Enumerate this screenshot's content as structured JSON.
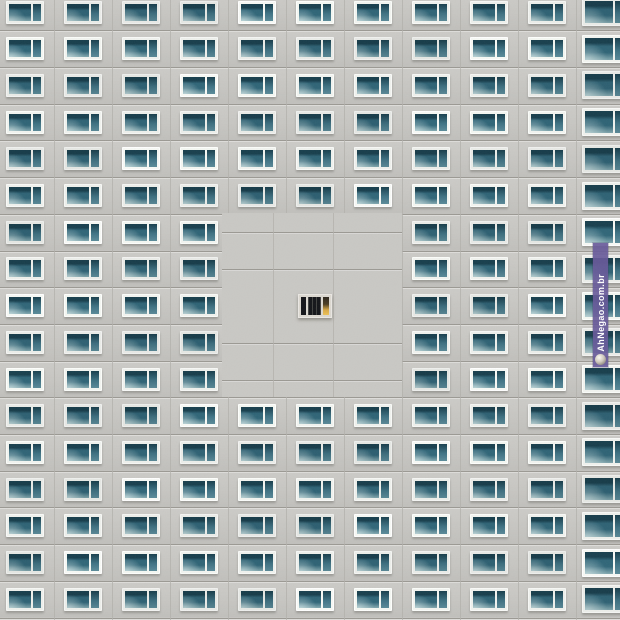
{
  "scene": {
    "description": "Prefab apartment building facade: uniform grid of teal windows, a cleared blank wall area in the middle, and one small lit window at its center",
    "colors": {
      "wall": "#c9c8c4",
      "floor_joint_line": "#9b9993",
      "panel_joint_line": "#b2b0ab"
    }
  },
  "facade": {
    "grid": {
      "columns": 11,
      "rows": 17,
      "col_start": 25,
      "col_step": 58,
      "row_start": 12,
      "row_step": 36.7
    },
    "window": {
      "width": 38,
      "height": 23,
      "frame_color": "#eef0ec",
      "glass_dark": "#173d4b",
      "glass_mid": "#2e6274",
      "glass_light": "#7fa4ab",
      "right_pane": "#3c6e7f"
    },
    "edge_window": {
      "width": 46,
      "height": 28
    },
    "blank_cells": [
      [
        7,
        5
      ],
      [
        7,
        6
      ],
      [
        7,
        7
      ],
      [
        8,
        5
      ],
      [
        8,
        6
      ],
      [
        8,
        7
      ],
      [
        9,
        5
      ],
      [
        9,
        7
      ],
      [
        10,
        5
      ],
      [
        10,
        6
      ],
      [
        10,
        7
      ],
      [
        11,
        5
      ],
      [
        11,
        6
      ],
      [
        11,
        7
      ]
    ],
    "blank_block": {
      "left": 222,
      "top": 213,
      "width": 180,
      "height": 184,
      "h_lines": [
        232,
        269,
        343,
        380
      ],
      "v_lines": [
        273,
        333
      ]
    },
    "lit_window": {
      "row": 9,
      "col": 6,
      "width": 34,
      "height": 24,
      "frame_color": "#dcd8d0",
      "pane_dark": "#141519",
      "glow_top": "#2e2820",
      "glow_bottom": "#d8a845"
    }
  },
  "watermark": {
    "text": "AhNegao.com.br",
    "bg_color": "rgba(103,89,153,0.92)",
    "text_color": "#ffffff",
    "icon": "mascot-face-icon",
    "left": 593,
    "top": 243,
    "width": 15,
    "height": 124
  }
}
